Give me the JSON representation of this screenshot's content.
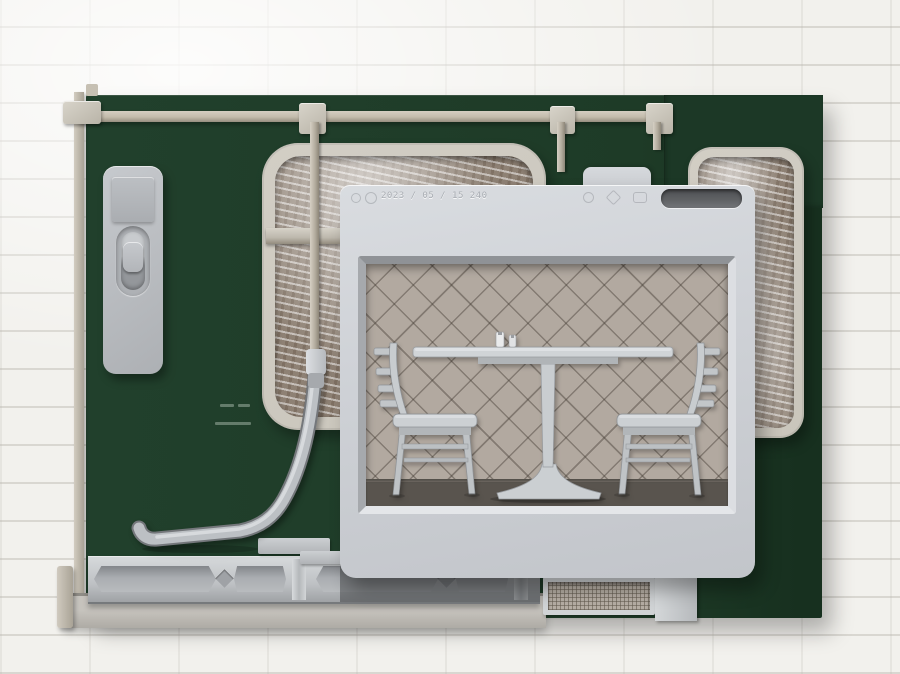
{
  "artwork": {
    "stamp": {
      "date_text": "2023 / 05 / 15 240"
    },
    "scene_objects": [
      "pedestal-table",
      "salt-shaker",
      "pepper-shaker",
      "ladder-back-chair-left",
      "ladder-back-chair-right"
    ]
  },
  "colors": {
    "wall": "#f2f1ed",
    "green": "#1e3b27",
    "green-dark": "#17301f",
    "panel": "#ced1d6",
    "rail-beige": "#c2bbab",
    "window-frame": "#c9c5bb",
    "scratch-base": "#8e8174",
    "lattice": "#b2a9a0",
    "floor": "#59544e",
    "furniture": "#c6cacd",
    "metal": "#bcc0c4",
    "slot": "#5f6164",
    "mesh": "#b6aea4"
  }
}
